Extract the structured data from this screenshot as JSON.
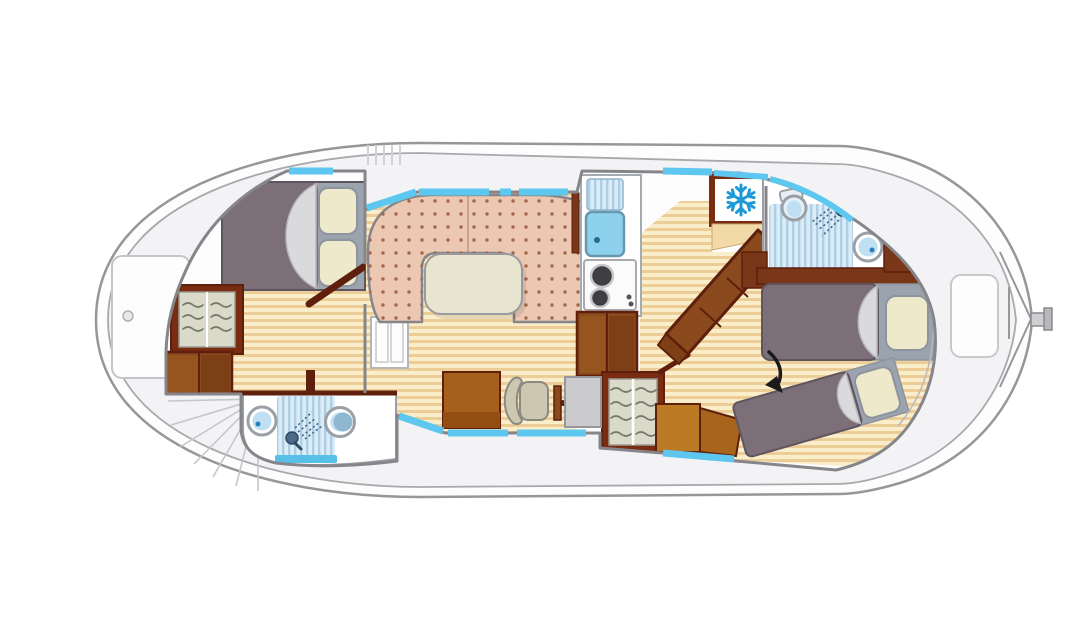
{
  "meta": {
    "kind": "canal-boat floor plan, top view, bow left / stern right",
    "canvas": {
      "width": 1092,
      "height": 640
    }
  },
  "palette": {
    "hull_fill": "#fdfdfe",
    "hull_stroke": "#97979b",
    "deck": "#f3f3f5",
    "deck_line": "#c6c6cb",
    "wall": "#86868a",
    "interior": "#fdfdfe",
    "wood_light": "#f9edca",
    "wood_stripe": "#edcd97",
    "frame_brown": "#7a2c12",
    "dark_brown": "#5e1f0c",
    "wood_mid": "#8a4a1e",
    "wood_plank_light": "#96551f",
    "wood_plank_dark": "#7d3f15",
    "wood_orange": "#bd7a24",
    "wood_orange_dark": "#a8641a",
    "wood_wall": "#7a3618",
    "mattress": "#7c6f77",
    "mattress_edge": "#5e5560",
    "bed_base": "#9aa3ae",
    "pillow": "#efe9cc",
    "pillow_edge": "#8d949e",
    "blanket": "#dadadd",
    "blanket_edge": "#b9b9bd",
    "sofa": "#ecc7b2",
    "sofa_dot": "#a3684b",
    "sofa_seam": "#b99984",
    "table": "#e7e4cf",
    "window_blue": "#5ec7ef",
    "sink_blue": "#8ed1ec",
    "fixture_blue": "#bfe0f2",
    "fixture_dark_blue": "#2a7fb8",
    "toilet_shadow": "#8fb8d0",
    "shower_bg": "#dcebf5",
    "shower_stripe": "#adcfe6",
    "shower_tray": "#58c0e8",
    "fixture_ring": "#9aa0a6",
    "spray": "#4a6a88",
    "snowflake": "#1e9ad6",
    "fridge_panel": "#f2d9a8",
    "metal": "#cfcfd2",
    "desk": "#cbcbcd",
    "chair": "#cdc7b2",
    "chair_edge": "#8a8a80",
    "bench": "#a5601c",
    "bench_band": "#934f12",
    "arrow": "#1a1a1a",
    "shelf_bg": "#d9dac9",
    "squiggle": "#77776a",
    "stove_burner": "#3f3f43"
  },
  "icons": {
    "snowflake": "snowflake-icon (freezer/cool box)",
    "shower_head": "shower-head-icon with dashed spray",
    "toilet": "toilet-icon (round bowl)",
    "sink": "sink-icon (round basin with drain dot)",
    "stove": "stove-burners-icon (two rings)",
    "arrow": "conversion-arrow-icon (curved black arrow between aft beds)",
    "hanger": "clothes-shelf-squiggle-icon"
  },
  "layout": {
    "orientation": {
      "bow": "left",
      "stern": "right"
    },
    "areas": [
      {
        "name": "bow-deck",
        "fixtures": [
          "deck-hatch",
          "fan-steps"
        ]
      },
      {
        "name": "bow-cabin",
        "fixtures": [
          "double-bed",
          "wardrobe",
          "storage-steps",
          "door"
        ]
      },
      {
        "name": "forward-bathroom",
        "fixtures": [
          "sink",
          "shower",
          "toilet"
        ]
      },
      {
        "name": "salon",
        "fixtures": [
          "u-shaped-sofa",
          "dinette-table",
          "bench",
          "chair",
          "vanity-desk"
        ]
      },
      {
        "name": "galley",
        "fixtures": [
          "drainboard",
          "sink",
          "stove",
          "steps",
          "freezer-box"
        ]
      },
      {
        "name": "mid-wardrobe",
        "fixtures": [
          "shelves"
        ]
      },
      {
        "name": "companionway",
        "fixtures": [
          "angled-steps"
        ]
      },
      {
        "name": "aft-bathroom",
        "fixtures": [
          "toilet",
          "shower",
          "sink"
        ]
      },
      {
        "name": "aft-cabin",
        "fixtures": [
          "single-bed",
          "angled-single-bed",
          "cabinet",
          "conversion-arrow"
        ]
      },
      {
        "name": "stern-deck",
        "fixtures": [
          "locker",
          "rudder-tiller"
        ]
      }
    ]
  }
}
